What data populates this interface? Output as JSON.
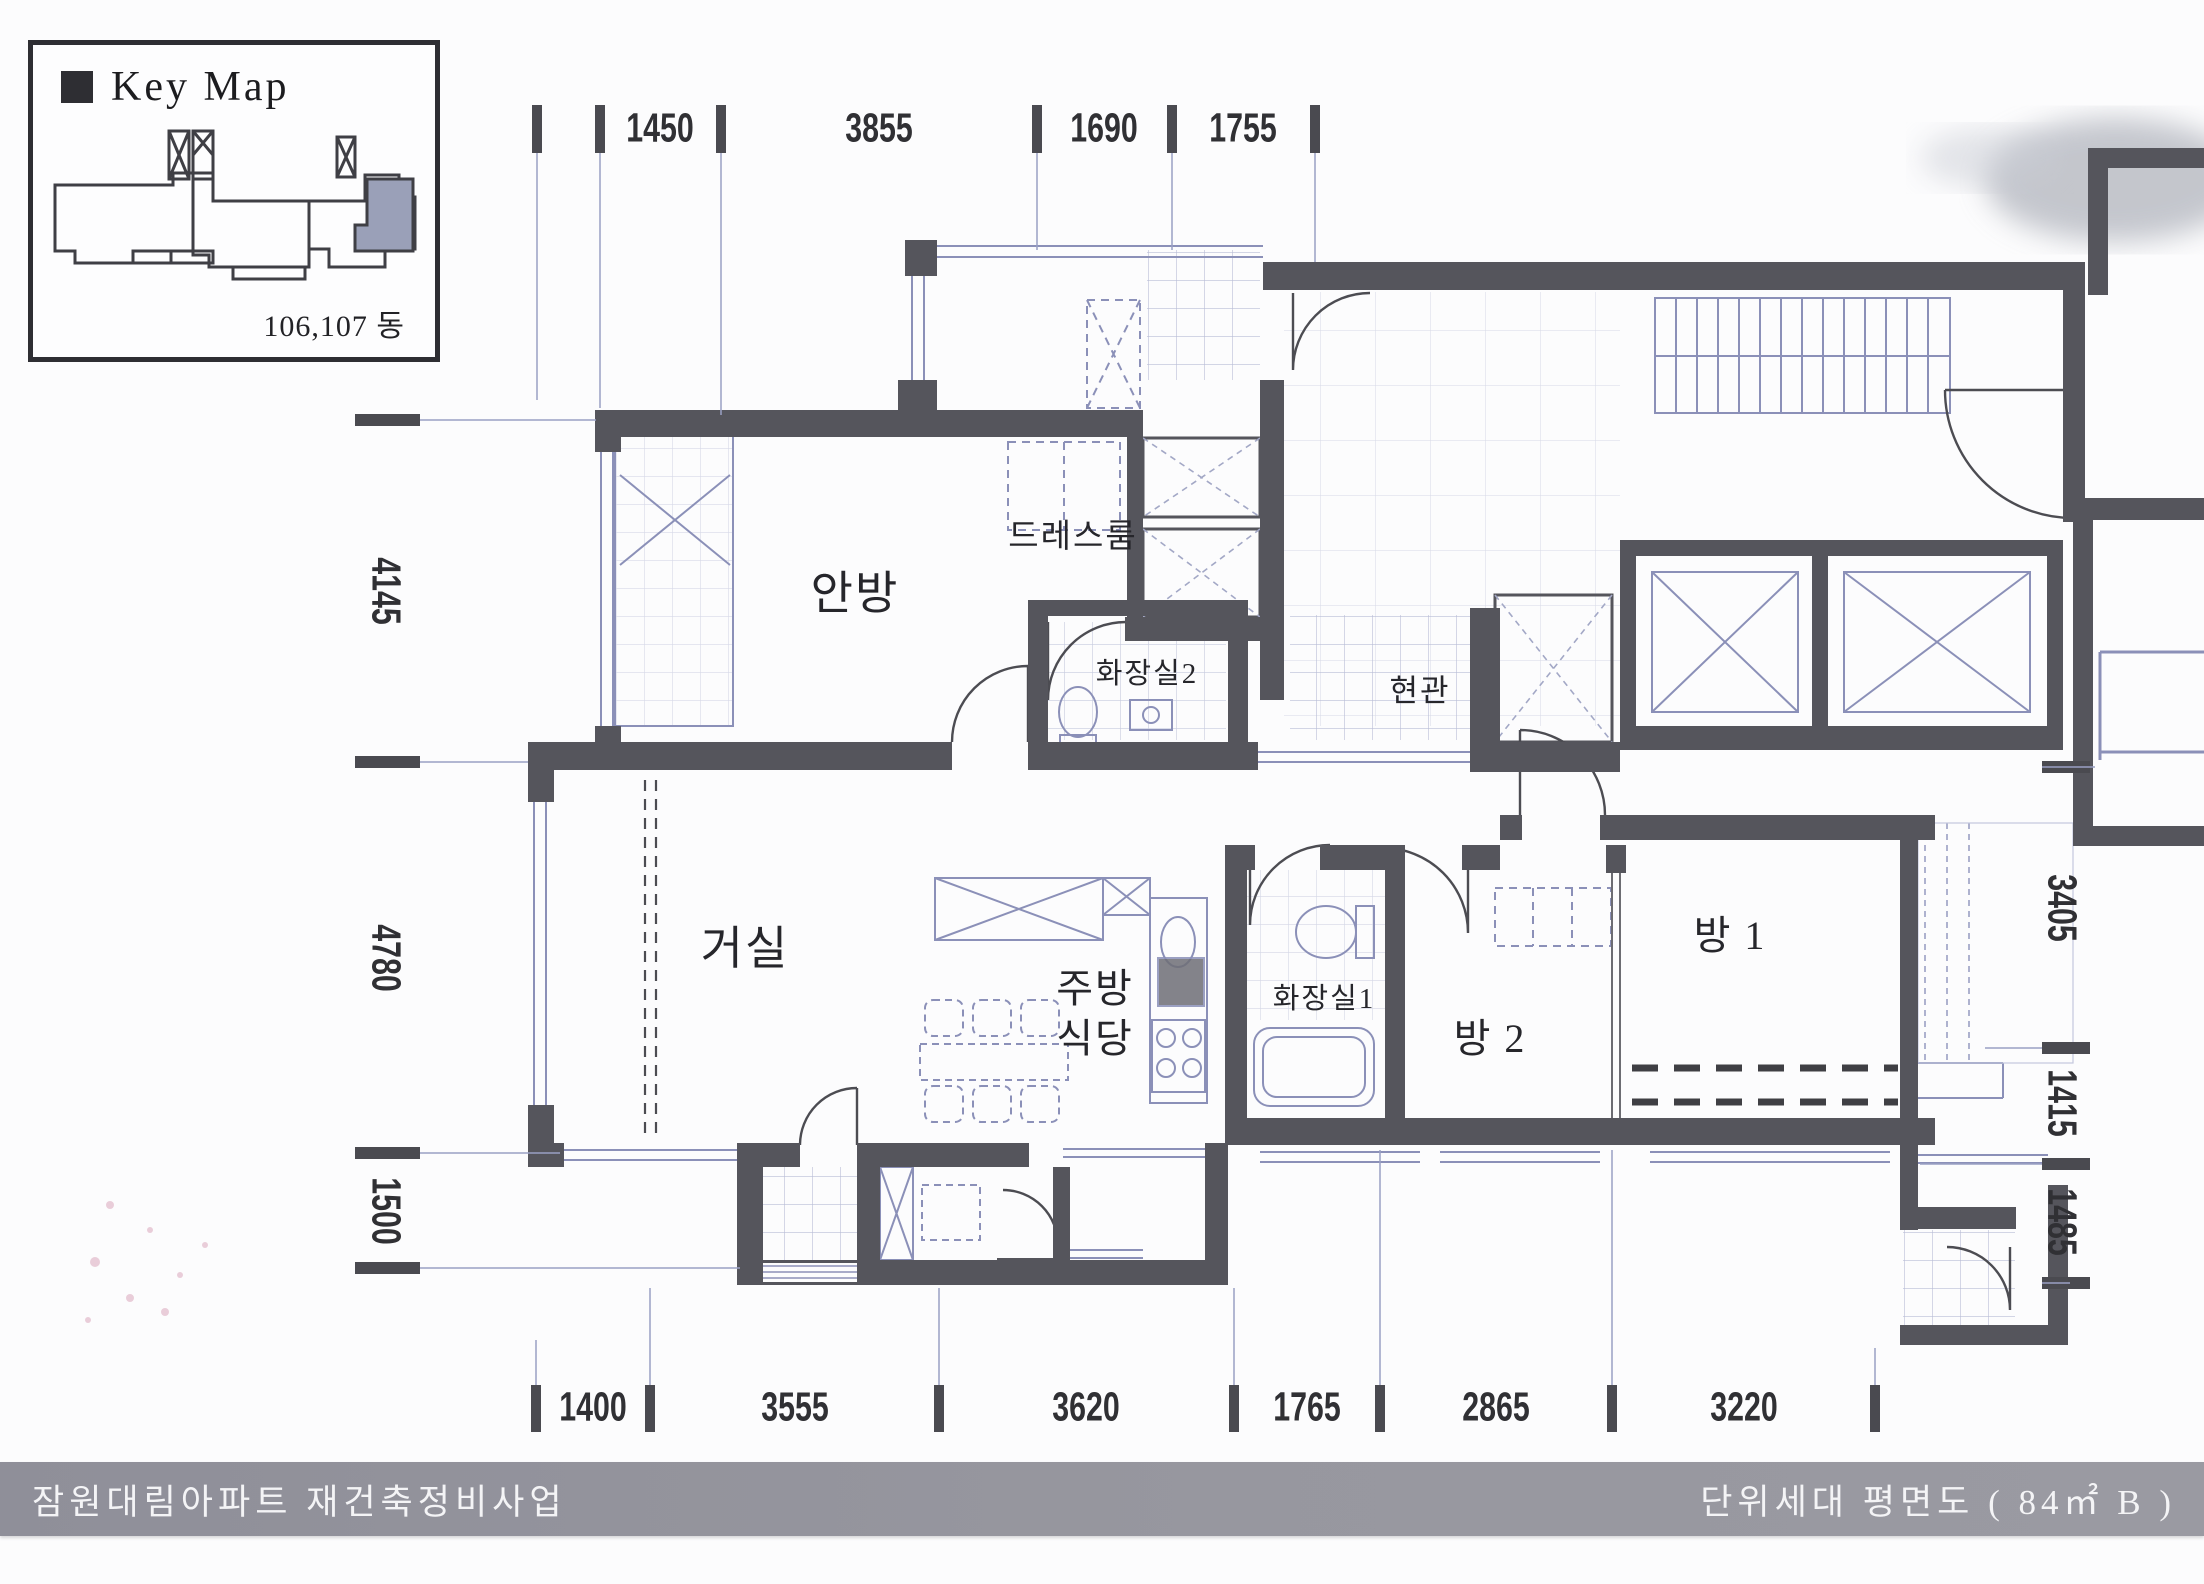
{
  "key_map": {
    "title": "Key Map",
    "building_label": "106,107 동"
  },
  "rooms": {
    "master_bedroom": "안방",
    "dress_room": "드레스룸",
    "bathroom2": "화장실2",
    "entrance": "현관",
    "living_room": "거실",
    "kitchen": "주방",
    "dining": "식당",
    "bathroom1": "화장실1",
    "room2": "방 2",
    "room1": "방 1"
  },
  "dimensions": {
    "unit": "mm",
    "top": [
      "1450",
      "3855",
      "1690",
      "1755"
    ],
    "left": [
      "4145",
      "4780",
      "1500"
    ],
    "right": [
      "3405",
      "1415",
      "1485"
    ],
    "bottom": [
      "1400",
      "3555",
      "3620",
      "1765",
      "2865",
      "3220"
    ]
  },
  "footer": {
    "project": "잠원대림아파트 재건축정비사업",
    "drawing_title": "단위세대 평면도 ( 84㎡ B )"
  },
  "colors": {
    "wall": "#55555c",
    "thin_line": "#8b90b8",
    "tile_line": "#b9bdd6",
    "dim_text": "#303034",
    "footer_bar": "#95959e",
    "keymap_highlight": "#9aa0b8"
  }
}
